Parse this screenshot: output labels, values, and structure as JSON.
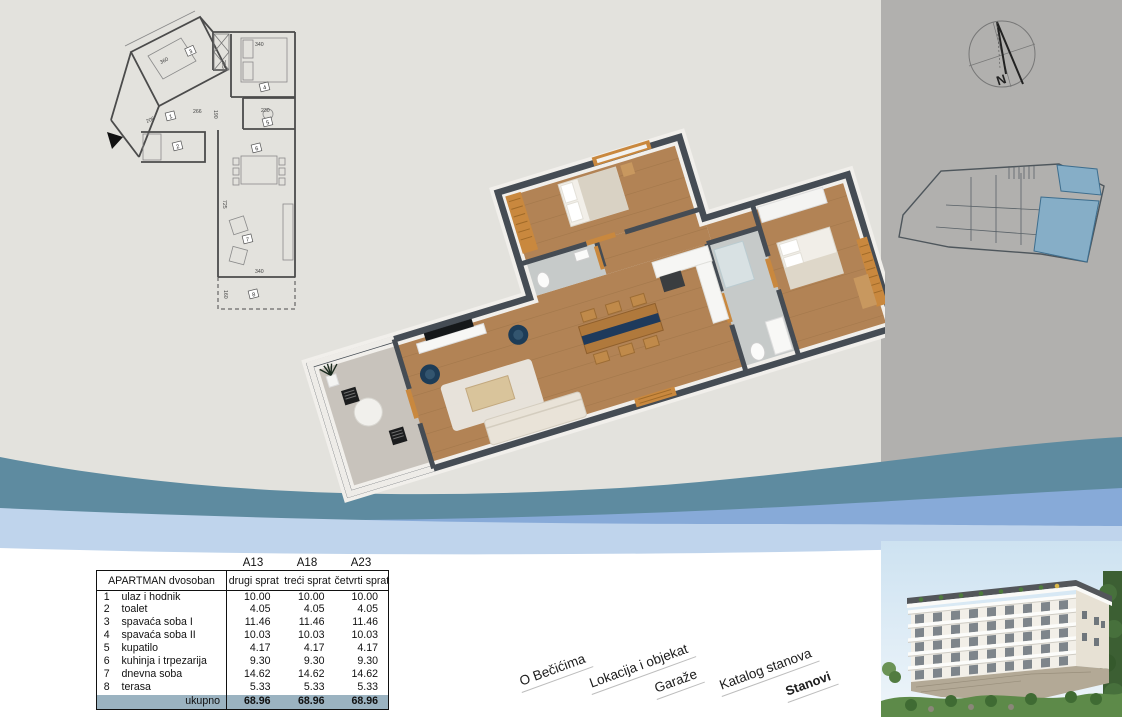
{
  "page": {
    "background": "#e3e2dd",
    "right_panel_color": "#b1b0ae",
    "bottom_color": "#ffffff"
  },
  "waves": {
    "teal": "#5e8ba0",
    "blue": "#87aad8",
    "light_blue": "#bfd4ec"
  },
  "compass": {
    "label": "N"
  },
  "plan2d": {
    "room_tags": [
      "1",
      "2",
      "3",
      "4",
      "5",
      "6",
      "7",
      "8"
    ],
    "dims": {
      "bedroom1": "360",
      "bedroom2": "340",
      "wardrobe": "285",
      "hall_a": "266",
      "hall_b": "190",
      "hall_c": "206",
      "toilet": "230",
      "living_h": "725",
      "living_w": "340",
      "terrace_h": "160"
    }
  },
  "key_plan": {
    "highlight_color": "#86aec7"
  },
  "table": {
    "unit_ids": [
      "A13",
      "A18",
      "A23"
    ],
    "header_label": "APARTMAN dvosoban",
    "floor_labels": [
      "drugi sprat",
      "treći sprat",
      "četvrti sprat"
    ],
    "rows": [
      {
        "n": "1",
        "name": "ulaz i hodnik",
        "values": [
          "10.00",
          "10.00",
          "10.00"
        ]
      },
      {
        "n": "2",
        "name": "toalet",
        "values": [
          "4.05",
          "4.05",
          "4.05"
        ]
      },
      {
        "n": "3",
        "name": "spavaća soba I",
        "values": [
          "11.46",
          "11.46",
          "11.46"
        ]
      },
      {
        "n": "4",
        "name": "spavaća soba II",
        "values": [
          "10.03",
          "10.03",
          "10.03"
        ]
      },
      {
        "n": "5",
        "name": "kupatilo",
        "values": [
          "4.17",
          "4.17",
          "4.17"
        ]
      },
      {
        "n": "6",
        "name": "kuhinja i trpezarija",
        "values": [
          "9.30",
          "9.30",
          "9.30"
        ]
      },
      {
        "n": "7",
        "name": "dnevna soba",
        "values": [
          "14.62",
          "14.62",
          "14.62"
        ]
      },
      {
        "n": "8",
        "name": "terasa",
        "values": [
          "5.33",
          "5.33",
          "5.33"
        ]
      }
    ],
    "total": {
      "label": "ukupno",
      "values": [
        "68.96",
        "68.96",
        "68.96"
      ],
      "row_color": "#9bb3c1"
    }
  },
  "nav": {
    "items": [
      {
        "label": "O Bečićima",
        "active": false
      },
      {
        "label": "Lokacija i objekat",
        "active": false
      },
      {
        "label": "Garaže",
        "active": false
      },
      {
        "label": "Katalog stanova",
        "active": false
      },
      {
        "label": "Stanovi",
        "active": true
      }
    ]
  }
}
